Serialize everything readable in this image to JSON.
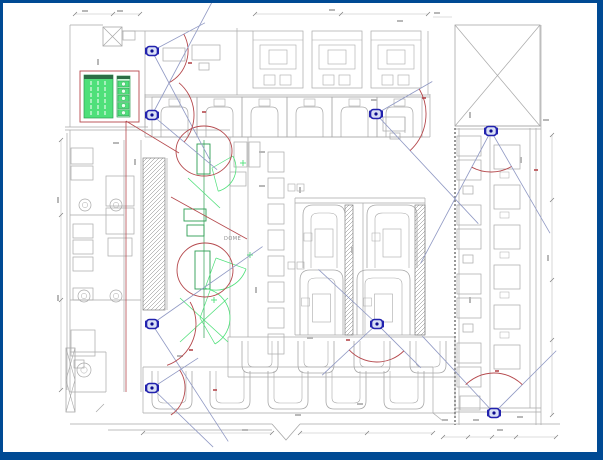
{
  "colors": {
    "frame": "#004a94",
    "line": "#a9a9a9",
    "line_dark": "#7f7f7f",
    "dim": "#bcbcbc",
    "red": "#b5494d",
    "green": "#4fe07a",
    "green_dark": "#2e9e53",
    "green_header": "#2c6e46",
    "green_cell_bg": "#c9f6d6",
    "camera": "#2222ae",
    "camera_inner": "#d9e0f5",
    "camera_dot": "#0d0d8e",
    "fov": "#9099c4",
    "smudge": "#b8b8b8"
  },
  "labels": {
    "area_label": "DOME"
  },
  "cameras": [
    {
      "id": "cam-1",
      "x": 152,
      "y": 51,
      "rays": [
        [
          -28,
          60
        ],
        [
          62,
          125
        ]
      ],
      "arc": [
        36,
        -28,
        62
      ]
    },
    {
      "id": "cam-2",
      "x": 152,
      "y": 115,
      "rays": [
        [
          -62,
          130
        ],
        [
          40,
          85
        ]
      ],
      "arc": [
        42,
        -50,
        40
      ]
    },
    {
      "id": "cam-3",
      "x": 376,
      "y": 114,
      "rays": [
        [
          -30,
          65
        ],
        [
          47,
          150
        ]
      ],
      "arc": [
        50,
        -30,
        47
      ]
    },
    {
      "id": "cam-4",
      "x": 491,
      "y": 131,
      "rays": [
        [
          118,
          150
        ],
        [
          60,
          118
        ]
      ],
      "arc": [
        41,
        60,
        118
      ]
    },
    {
      "id": "cam-5",
      "x": 152,
      "y": 324,
      "rays": [
        [
          -35,
          135
        ],
        [
          57,
          140
        ]
      ],
      "arc": [
        44,
        -30,
        70
      ]
    },
    {
      "id": "cam-6",
      "x": 377,
      "y": 324,
      "rays": [
        [
          137,
          75
        ],
        [
          45,
          62
        ],
        [
          -137,
          80
        ]
      ],
      "arc": [
        38,
        45,
        137
      ]
    },
    {
      "id": "cam-7",
      "x": 152,
      "y": 388,
      "rays": [
        [
          -33,
          55
        ],
        [
          44,
          85
        ]
      ],
      "arc": [
        33,
        -33,
        55
      ]
    },
    {
      "id": "cam-8",
      "x": 494,
      "y": 413,
      "rays": [
        [
          -133,
          105
        ],
        [
          -45,
          88
        ]
      ],
      "arc": [
        40,
        -135,
        -45
      ]
    }
  ],
  "red_annotations": {
    "circles": [
      [
        204,
        151,
        28,
        25
      ],
      [
        205,
        270,
        28,
        27
      ]
    ],
    "lines": [
      [
        126,
        121,
        179,
        153
      ],
      [
        126,
        121,
        126,
        392
      ],
      [
        171,
        197,
        247,
        239
      ]
    ],
    "marks": [
      [
        190,
        63
      ],
      [
        204,
        112
      ],
      [
        424,
        98
      ],
      [
        191,
        350
      ],
      [
        348,
        340
      ],
      [
        497,
        371
      ],
      [
        536,
        170
      ],
      [
        215,
        390
      ]
    ]
  },
  "green_annotations": {
    "vline": [
      204,
      140,
      204,
      338
    ],
    "rects": [
      [
        197,
        144,
        13,
        30
      ],
      [
        184,
        209,
        22,
        12
      ],
      [
        187,
        225,
        17,
        11
      ],
      [
        195,
        251,
        15,
        38
      ]
    ],
    "lines": [
      [
        188,
        178,
        220,
        208
      ],
      [
        180,
        298,
        228,
        342
      ],
      [
        228,
        298,
        180,
        342
      ]
    ],
    "arcs": [
      {
        "cx": 212,
        "cy": 168,
        "r": 24,
        "a1": -30,
        "a2": 75
      },
      {
        "cx": 216,
        "cy": 258,
        "r": 32,
        "a1": 20,
        "a2": 110
      },
      {
        "cx": 200,
        "cy": 318,
        "r": 30,
        "a1": -70,
        "a2": 60
      }
    ],
    "crosses": [
      [
        243,
        163
      ],
      [
        250,
        255
      ],
      [
        214,
        300
      ]
    ]
  },
  "legend": {
    "red_rect": [
      80,
      71,
      59,
      51
    ],
    "main": {
      "x": 84,
      "y": 75,
      "w": 29,
      "h": 43,
      "header_h": 4,
      "col_lines_x": [
        91,
        98,
        105
      ]
    },
    "strip": {
      "x": 117,
      "y": 76,
      "w": 13,
      "h": 41,
      "header_h": 3,
      "cells": 5,
      "cell_h": 6,
      "cell_step": 7.2
    }
  },
  "plan": {
    "lines": [
      [
        70,
        25,
        103,
        25
      ],
      [
        122,
        31,
        253,
        31
      ],
      [
        70,
        25,
        70,
        127
      ],
      [
        145,
        31,
        145,
        127
      ],
      [
        65,
        127,
        148,
        127
      ],
      [
        65,
        130,
        230,
        130
      ],
      [
        70,
        130,
        70,
        392
      ],
      [
        67,
        133,
        67,
        390
      ],
      [
        145,
        95,
        430,
        95
      ],
      [
        145,
        97,
        430,
        97
      ],
      [
        145,
        137,
        430,
        137
      ],
      [
        430,
        94,
        430,
        137
      ],
      [
        145,
        94,
        145,
        137
      ],
      [
        237,
        28,
        237,
        95
      ],
      [
        428,
        31,
        428,
        95
      ],
      [
        455,
        126,
        541,
        126
      ],
      [
        455,
        129,
        541,
        129
      ],
      [
        230,
        137,
        230,
        337
      ],
      [
        248,
        137,
        248,
        337
      ],
      [
        295,
        198,
        425,
        198
      ],
      [
        295,
        203,
        425,
        203
      ],
      [
        295,
        335,
        425,
        335
      ],
      [
        295,
        198,
        295,
        335
      ],
      [
        363,
        203,
        363,
        335
      ],
      [
        425,
        198,
        425,
        335
      ],
      [
        228,
        337,
        455,
        337
      ],
      [
        228,
        337,
        228,
        377
      ],
      [
        455,
        337,
        455,
        418
      ],
      [
        228,
        377,
        455,
        377
      ],
      [
        143,
        367,
        433,
        367
      ],
      [
        143,
        367,
        143,
        413
      ],
      [
        433,
        367,
        433,
        413
      ],
      [
        143,
        413,
        455,
        413
      ],
      [
        70,
        424,
        272,
        424
      ],
      [
        300,
        424,
        560,
        424
      ],
      [
        108,
        430,
        272,
        430
      ],
      [
        70,
        352,
        106,
        352
      ],
      [
        106,
        352,
        106,
        392
      ],
      [
        70,
        392,
        106,
        392
      ],
      [
        124,
        140,
        124,
        392
      ],
      [
        141,
        140,
        141,
        392
      ],
      [
        167,
        158,
        167,
        310
      ],
      [
        70,
        215,
        124,
        215
      ],
      [
        70,
        300,
        141,
        300
      ],
      [
        459,
        128,
        459,
        425
      ],
      [
        530,
        128,
        530,
        408
      ],
      [
        536,
        128,
        536,
        425
      ],
      [
        541,
        25,
        541,
        425
      ],
      [
        455,
        408,
        541,
        408
      ],
      [
        455,
        412,
        541,
        412
      ],
      [
        490,
        131,
        490,
        408
      ],
      [
        96,
        412,
        104,
        404
      ],
      [
        433,
        413,
        443,
        421
      ],
      [
        405,
        117,
        405,
        133
      ]
    ],
    "rects": [
      [
        123,
        31,
        12,
        9
      ],
      [
        71,
        148,
        22,
        16
      ],
      [
        71,
        166,
        22,
        14
      ],
      [
        73,
        224,
        20,
        14
      ],
      [
        73,
        240,
        20,
        14
      ],
      [
        73,
        257,
        20,
        14
      ],
      [
        73,
        288,
        20,
        12
      ],
      [
        71,
        330,
        24,
        26
      ],
      [
        74,
        360,
        10,
        8
      ],
      [
        106,
        176,
        28,
        30
      ],
      [
        106,
        208,
        28,
        26
      ],
      [
        108,
        238,
        24,
        18
      ],
      [
        163,
        48,
        22,
        13
      ],
      [
        192,
        45,
        28,
        15
      ],
      [
        199,
        63,
        10,
        7
      ],
      [
        383,
        117,
        22,
        14
      ],
      [
        390,
        133,
        10,
        6
      ],
      [
        460,
        396,
        20,
        14
      ],
      [
        234,
        142,
        13,
        25
      ],
      [
        249,
        142,
        11,
        25
      ],
      [
        230,
        172,
        16,
        14
      ],
      [
        463,
        186,
        10,
        8
      ],
      [
        463,
        255,
        10,
        8
      ],
      [
        463,
        324,
        10,
        8
      ]
    ],
    "circles": [
      [
        85,
        205,
        6
      ],
      [
        116,
        205,
        6
      ],
      [
        84,
        296,
        6
      ],
      [
        116,
        296,
        6
      ],
      [
        84,
        370,
        7
      ]
    ],
    "xboxes": [
      [
        103,
        27,
        19,
        19
      ],
      [
        455,
        25,
        85,
        101
      ]
    ],
    "xbox_strip": [
      66,
      348,
      9,
      64
    ],
    "hatches": [
      [
        143,
        158,
        22,
        152
      ],
      [
        345,
        205,
        8,
        130
      ],
      [
        415,
        205,
        10,
        130
      ]
    ],
    "dashed_wall": [
      455,
      128,
      455,
      425
    ],
    "zigzag": "M272,424 L286,440 L300,424",
    "top_booths": [
      253,
      312,
      371
    ],
    "arch_booths": [
      152,
      197,
      242,
      287,
      332,
      377
    ],
    "nested_u": [
      [
        303,
        205,
        42,
        63
      ],
      [
        367,
        205,
        50,
        63
      ],
      [
        300,
        270,
        43,
        65
      ],
      [
        357,
        270,
        53,
        65
      ]
    ],
    "u_rows": [
      {
        "y": 341,
        "h": 32,
        "w": 36,
        "xs": [
          242,
          298,
          354,
          410
        ]
      },
      {
        "y": 371,
        "h": 38,
        "w": 40,
        "xs": [
          152,
          210,
          268,
          326,
          384
        ]
      }
    ],
    "small_tables": {
      "x": 268,
      "y0": 152,
      "step": 26,
      "n": 8,
      "w": 16,
      "h": 20,
      "pairs": [
        [
          288,
          184
        ],
        [
          288,
          262
        ]
      ]
    },
    "right_strip": {
      "left_pairs_y": [
        136,
        205,
        274,
        343
      ],
      "left_x": 457,
      "left_w": 24,
      "left_h": 20,
      "right_x": 494,
      "right_y0": 145,
      "right_step": 40,
      "right_n": 6,
      "right_w": 26,
      "right_h": 24
    },
    "dim_lines": [
      [
        255,
        14,
        428,
        14
      ],
      [
        75,
        14,
        140,
        14
      ],
      [
        61,
        140,
        61,
        390
      ],
      [
        552,
        135,
        552,
        415
      ],
      [
        443,
        437,
        556,
        437
      ],
      [
        143,
        433,
        272,
        433
      ],
      [
        300,
        433,
        433,
        433
      ],
      [
        433,
        17,
        452,
        17
      ]
    ],
    "ticks": [
      [
        255,
        14
      ],
      [
        341,
        14
      ],
      [
        428,
        14
      ],
      [
        75,
        14
      ],
      [
        113,
        14
      ],
      [
        140,
        14
      ],
      [
        61,
        140
      ],
      [
        61,
        215
      ],
      [
        61,
        300
      ],
      [
        61,
        390
      ],
      [
        552,
        135
      ],
      [
        552,
        200
      ],
      [
        552,
        280
      ],
      [
        552,
        340
      ],
      [
        552,
        415
      ],
      [
        443,
        437
      ],
      [
        468,
        437
      ],
      [
        492,
        437
      ],
      [
        516,
        437
      ],
      [
        556,
        437
      ],
      [
        143,
        433
      ],
      [
        272,
        433
      ],
      [
        300,
        433
      ],
      [
        367,
        433
      ],
      [
        433,
        433
      ]
    ],
    "smudges": [
      [
        332,
        10,
        0
      ],
      [
        400,
        21,
        0
      ],
      [
        437,
        13,
        0
      ],
      [
        85,
        11,
        0
      ],
      [
        120,
        11,
        0
      ],
      [
        98,
        62,
        1
      ],
      [
        58,
        200,
        1
      ],
      [
        58,
        298,
        1
      ],
      [
        116,
        143,
        0
      ],
      [
        135,
        162,
        1
      ],
      [
        262,
        152,
        0
      ],
      [
        300,
        190,
        1
      ],
      [
        256,
        290,
        1
      ],
      [
        352,
        250,
        1
      ],
      [
        310,
        338,
        0
      ],
      [
        470,
        115,
        1
      ],
      [
        521,
        160,
        1
      ],
      [
        548,
        258,
        1
      ],
      [
        546,
        120,
        0
      ],
      [
        470,
        300,
        1
      ],
      [
        180,
        356,
        0
      ],
      [
        298,
        415,
        0
      ],
      [
        360,
        404,
        0
      ],
      [
        445,
        420,
        0
      ],
      [
        476,
        420,
        0
      ],
      [
        520,
        417,
        0
      ],
      [
        245,
        430,
        0
      ],
      [
        500,
        430,
        0
      ],
      [
        374,
        100,
        0
      ],
      [
        262,
        186,
        0
      ]
    ]
  },
  "label_pos": {
    "x": 224,
    "y": 236
  }
}
